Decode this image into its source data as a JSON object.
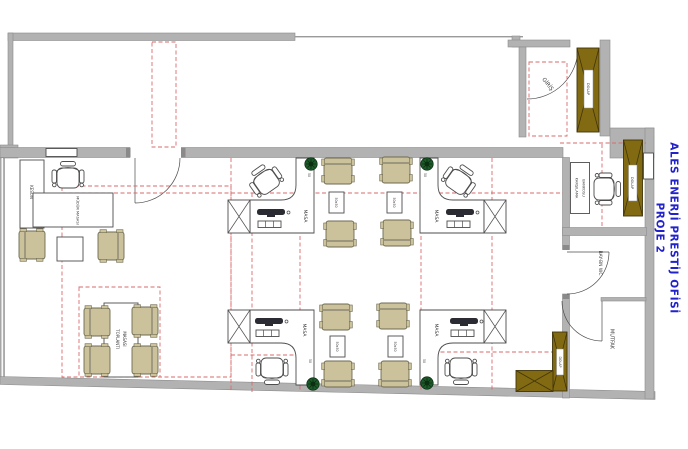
{
  "title": {
    "line1": "ALES ENERJİ PRESTİJ OFİSİ",
    "line2": "PROJE 2"
  },
  "labels": {
    "giris": "GİRİŞ",
    "karsilama_line1": "KARŞILAMA",
    "karsilama_line2": "BANKOSU",
    "wc": "BAY-BN WC",
    "mutfak": "MUTFAK",
    "dolap": "DOLAP",
    "keson": "KESON",
    "mudur_masasi": "MÜDÜR MASASI",
    "toplanti_line1": "TOPLANTI",
    "toplanti_line2": "MASASI",
    "masa": "MASA",
    "sehpa_dim": "50x50",
    "dim_50": "50"
  },
  "colors": {
    "wall": "#b2b2b2",
    "wall_stroke": "#8c8c8c",
    "line": "#4d4d4d",
    "chair_fill": "#cbc29b",
    "chair_stroke": "#6e6a50",
    "cabinet_fill": "#826a12",
    "cabinet_stroke": "#40350a",
    "red_dashed": "#d96b6b",
    "plant": "#1d5a2a",
    "title_blue": "#2222cc",
    "text": "#3d3d3d"
  }
}
